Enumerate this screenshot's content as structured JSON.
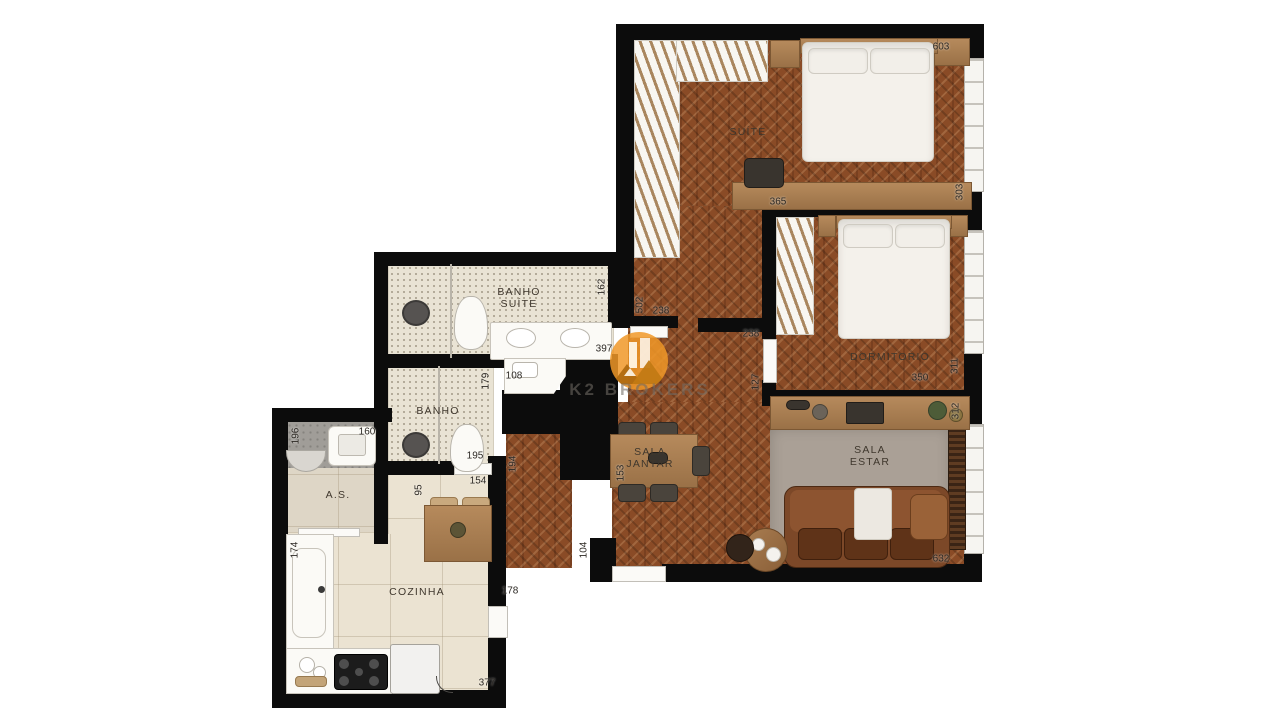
{
  "watermark": {
    "brand": "K2 BROKERS"
  },
  "colors": {
    "wall": "#0c0c0c",
    "wood": "#8a4b26",
    "accent_orange": "#f09828",
    "rug": "#aaa096",
    "bath_tile": "#e9e3d4",
    "kitchen_tile": "#ebe3d2"
  },
  "rooms": {
    "suite": {
      "label": "SUÍTE"
    },
    "dormitorio": {
      "label": "DORMITORIO"
    },
    "banho_suite": {
      "line1": "BANHO",
      "line2": "SUÍTE"
    },
    "banho": {
      "label": "BANHO"
    },
    "sala_jantar": {
      "line1": "SALA",
      "line2": "JANTAR"
    },
    "sala_estar": {
      "line1": "SALA",
      "line2": "ESTAR"
    },
    "area_servico": {
      "label": "A.S."
    },
    "cozinha": {
      "label": "COZINHA"
    }
  },
  "dimensions": {
    "suite_top": "603",
    "suite_right": "303",
    "suite_desk": "365",
    "banho_suite_right": "162",
    "hall_suite": "502",
    "hall_width_a": "238",
    "hall_width_b": "238",
    "dorm_door": "127",
    "banho_suite_counter": "397",
    "vanity": "108",
    "banho_right": "179",
    "banho_bottom": "195",
    "nook_top": "154",
    "nook_left": "95",
    "hall_lower": "194",
    "jantar_left": "153",
    "entry_wall": "104",
    "dorm_bottom": "350",
    "dorm_right": "311",
    "estar_right": "312",
    "estar_bottom": "632",
    "as_sink": "160",
    "as_left": "196",
    "as_lower_left": "174",
    "kitchen_right": "178",
    "kitchen_bottom": "377"
  }
}
